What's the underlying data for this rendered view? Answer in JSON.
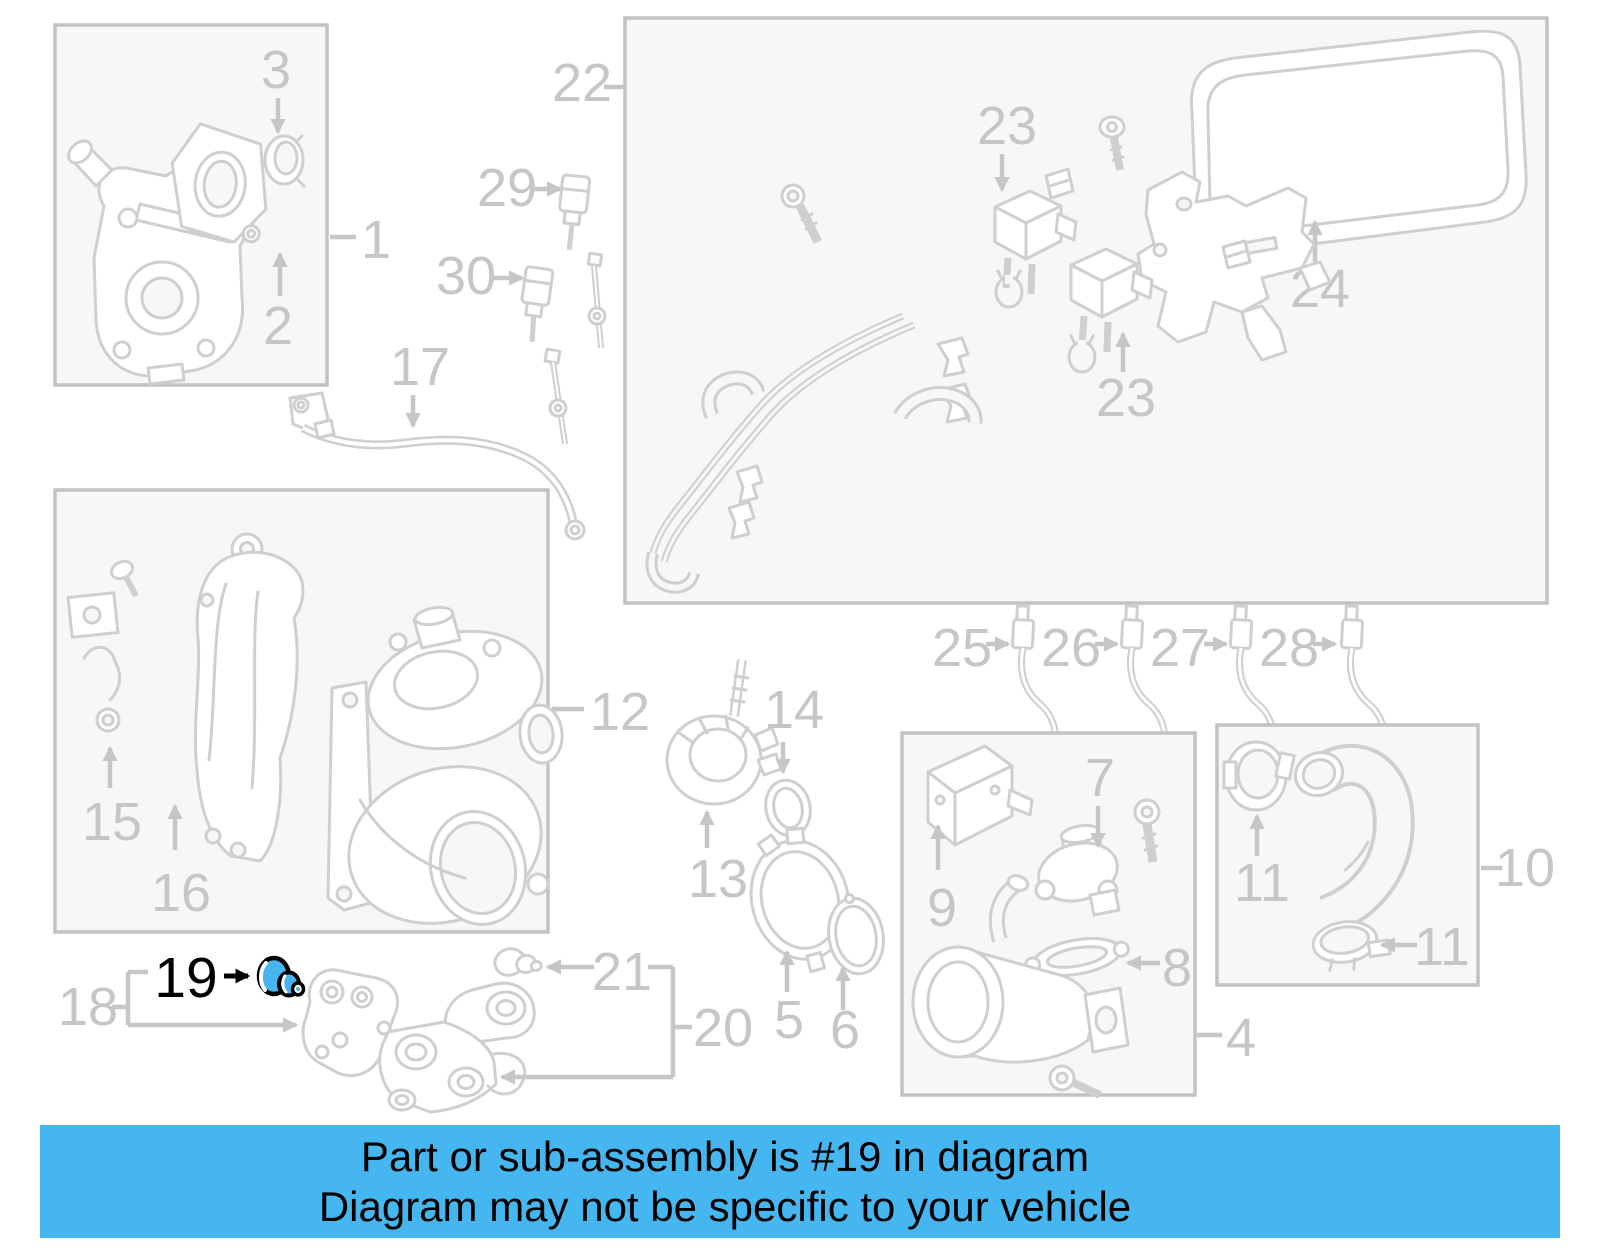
{
  "banner": {
    "line1": "Part or sub-assembly is #19 in diagram",
    "line2": "Diagram may not be specific to your vehicle"
  },
  "highlight": {
    "part_number": "19"
  },
  "parts": {
    "1": "1",
    "2": "2",
    "3": "3",
    "4": "4",
    "5": "5",
    "6": "6",
    "7": "7",
    "8": "8",
    "9": "9",
    "10": "10",
    "11": "11",
    "12": "12",
    "13": "13",
    "14": "14",
    "15": "15",
    "16": "16",
    "17": "17",
    "18": "18",
    "20": "20",
    "21": "21",
    "22": "22",
    "23": "23",
    "24": "24",
    "25": "25",
    "26": "26",
    "27": "27",
    "28": "28",
    "29": "29",
    "30": "30"
  },
  "colors": {
    "banner_background": "#45b6ef",
    "banner_text": "#000000",
    "highlight_fill": "#45b6ef",
    "highlight_outline": "#000000",
    "diagram_gray": "#c6c6c6"
  }
}
